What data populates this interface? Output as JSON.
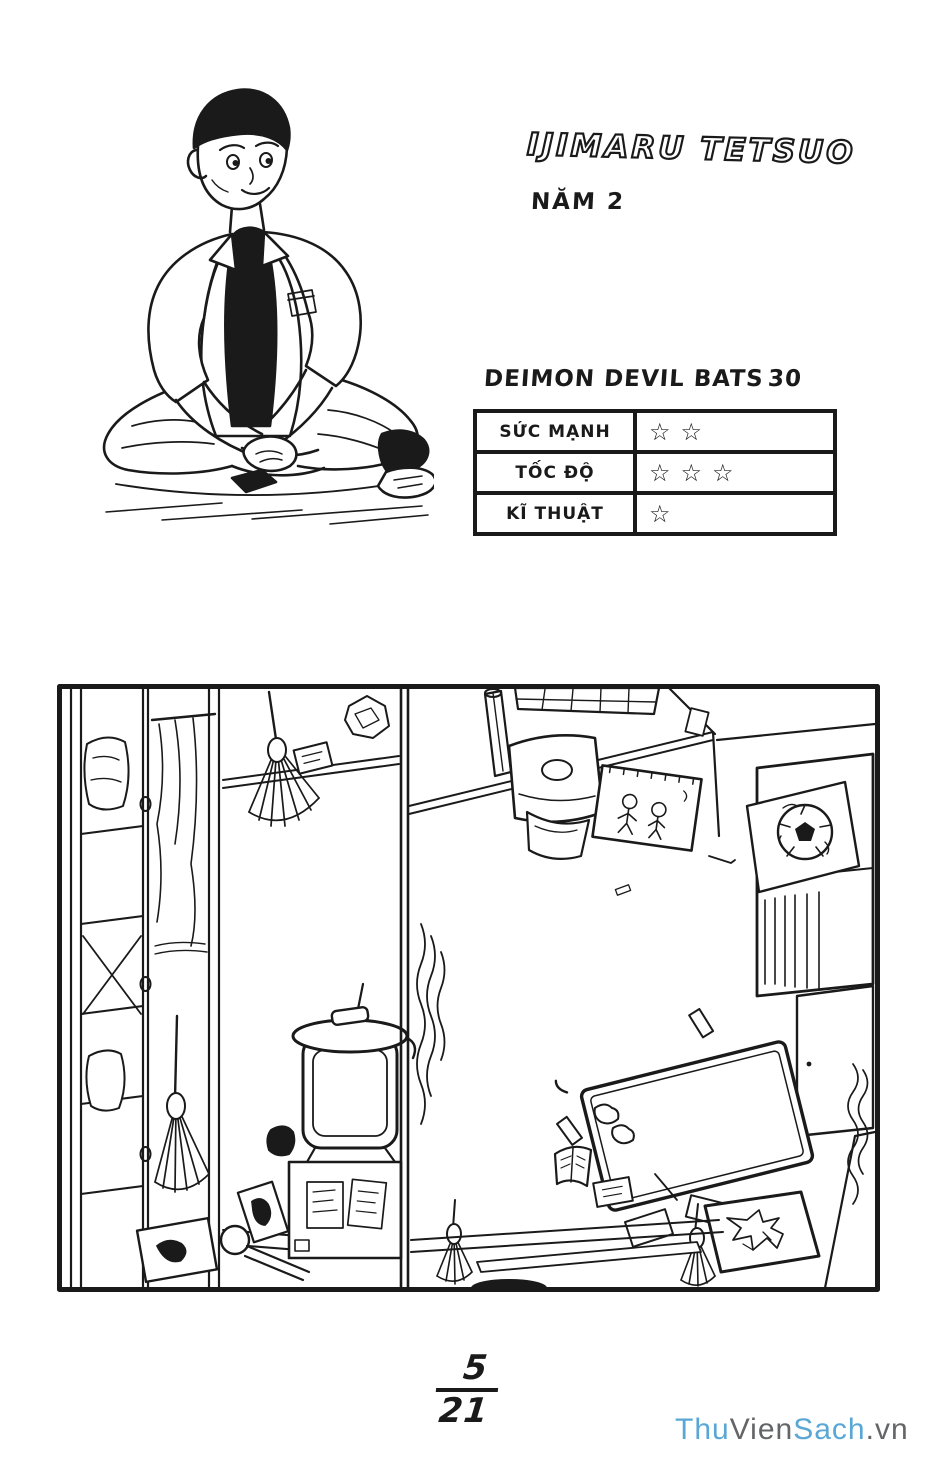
{
  "character_name": "IJIMARU TETSUO",
  "year_label": "NĂM 2",
  "team": {
    "name": "DEIMON DEVIL BATS",
    "number": "30"
  },
  "stats": {
    "star_glyph": "☆",
    "rows": [
      {
        "label": "SỨC MẠNH",
        "stars": 2
      },
      {
        "label": "TỐC ĐỘ",
        "stars": 3
      },
      {
        "label": "KĨ THUẬT",
        "stars": 1
      }
    ]
  },
  "page_number": {
    "numerator": "5",
    "denominator": "21"
  },
  "watermark": {
    "segments": [
      {
        "text": "Thu",
        "color": "#5aa7d6"
      },
      {
        "text": "Vien",
        "color": "#646567"
      },
      {
        "text": "Sach",
        "color": "#5aa7d6"
      },
      {
        "text": ".vn",
        "color": "#646567"
      }
    ]
  },
  "colors": {
    "ink": "#1a1a1a",
    "paper": "#ffffff"
  }
}
